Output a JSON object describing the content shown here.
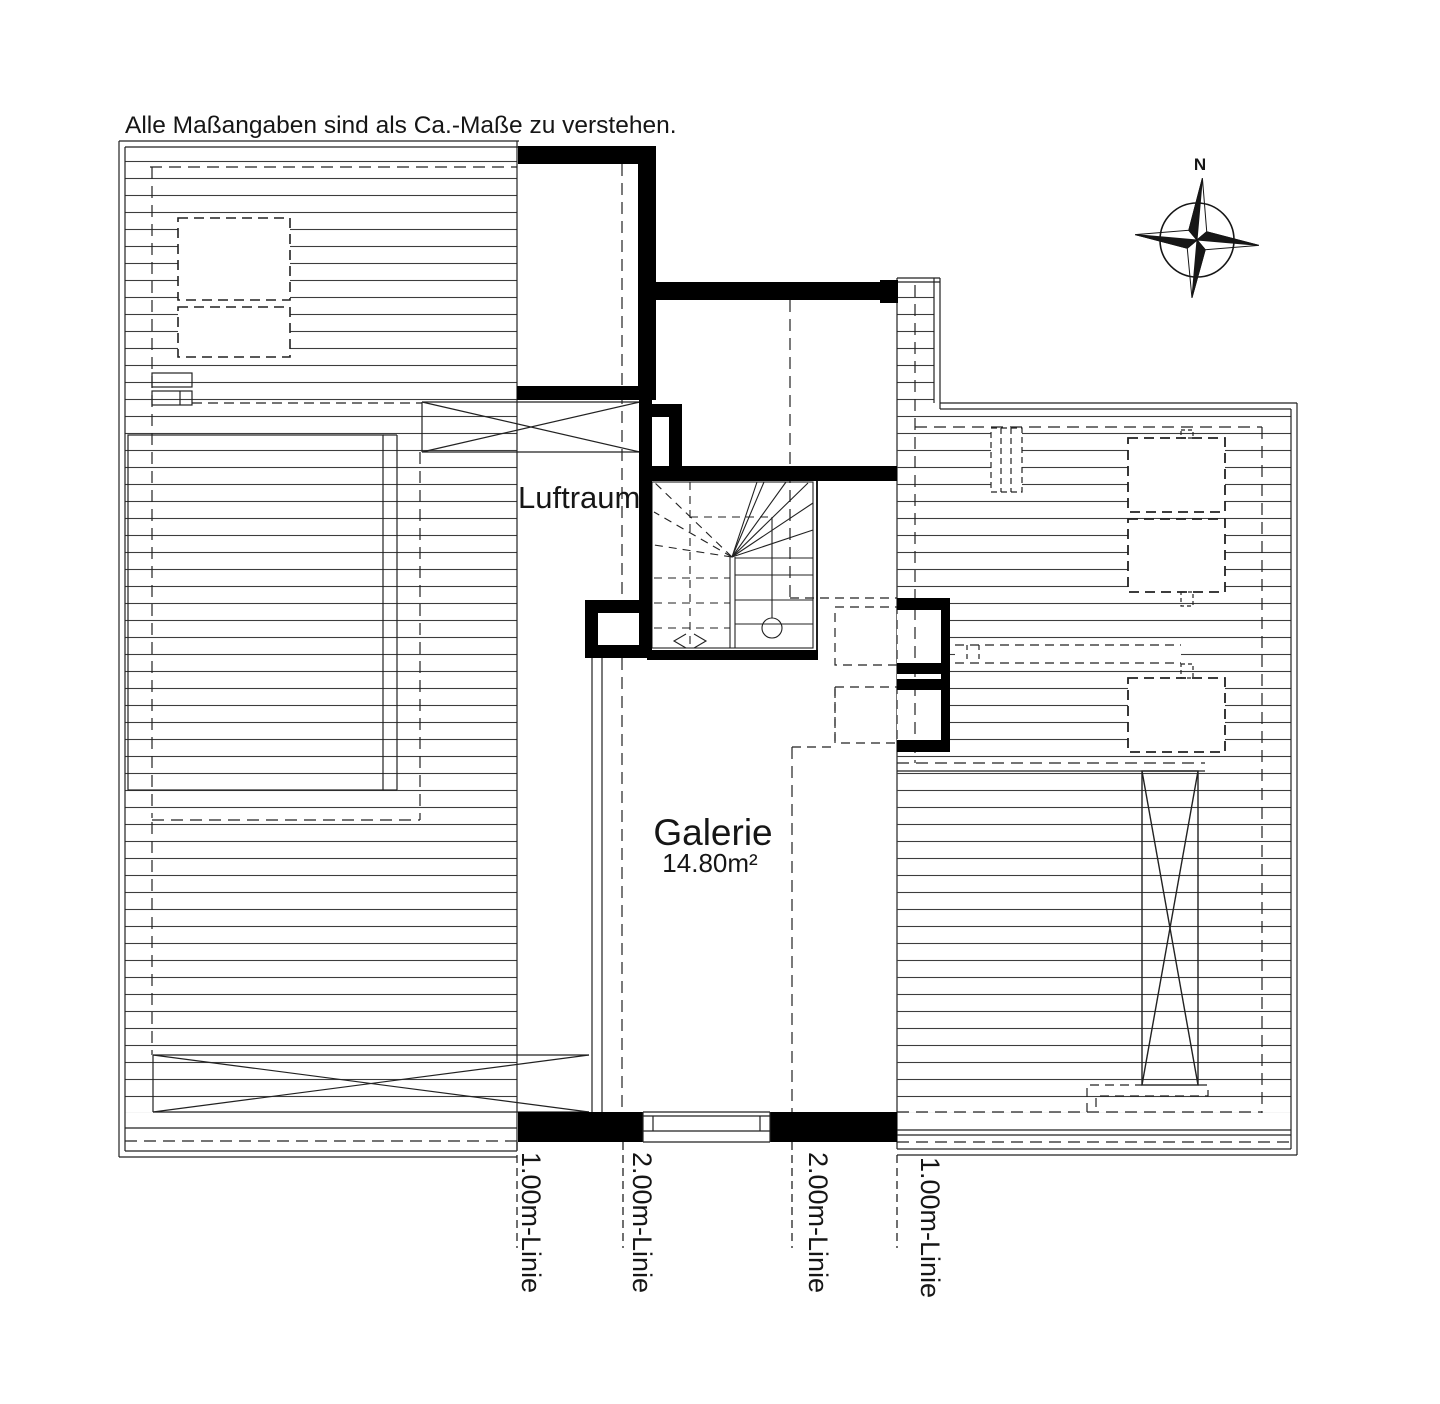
{
  "disclaimer": "Alle Maßangaben sind als Ca.-Maße zu verstehen.",
  "compass": {
    "label": "N"
  },
  "rooms": {
    "luftraum": {
      "label": "Luftraum"
    },
    "galerie": {
      "label": "Galerie",
      "area": "14.80m²"
    }
  },
  "dimension_labels": [
    "1.00m-Linie",
    "2.00m-Linie",
    "2.00m-Linie",
    "1.00m-Linie"
  ],
  "colors": {
    "ink": "#161616",
    "wall": "#000000",
    "hatch": "#3d3d3d",
    "background": "#ffffff"
  }
}
